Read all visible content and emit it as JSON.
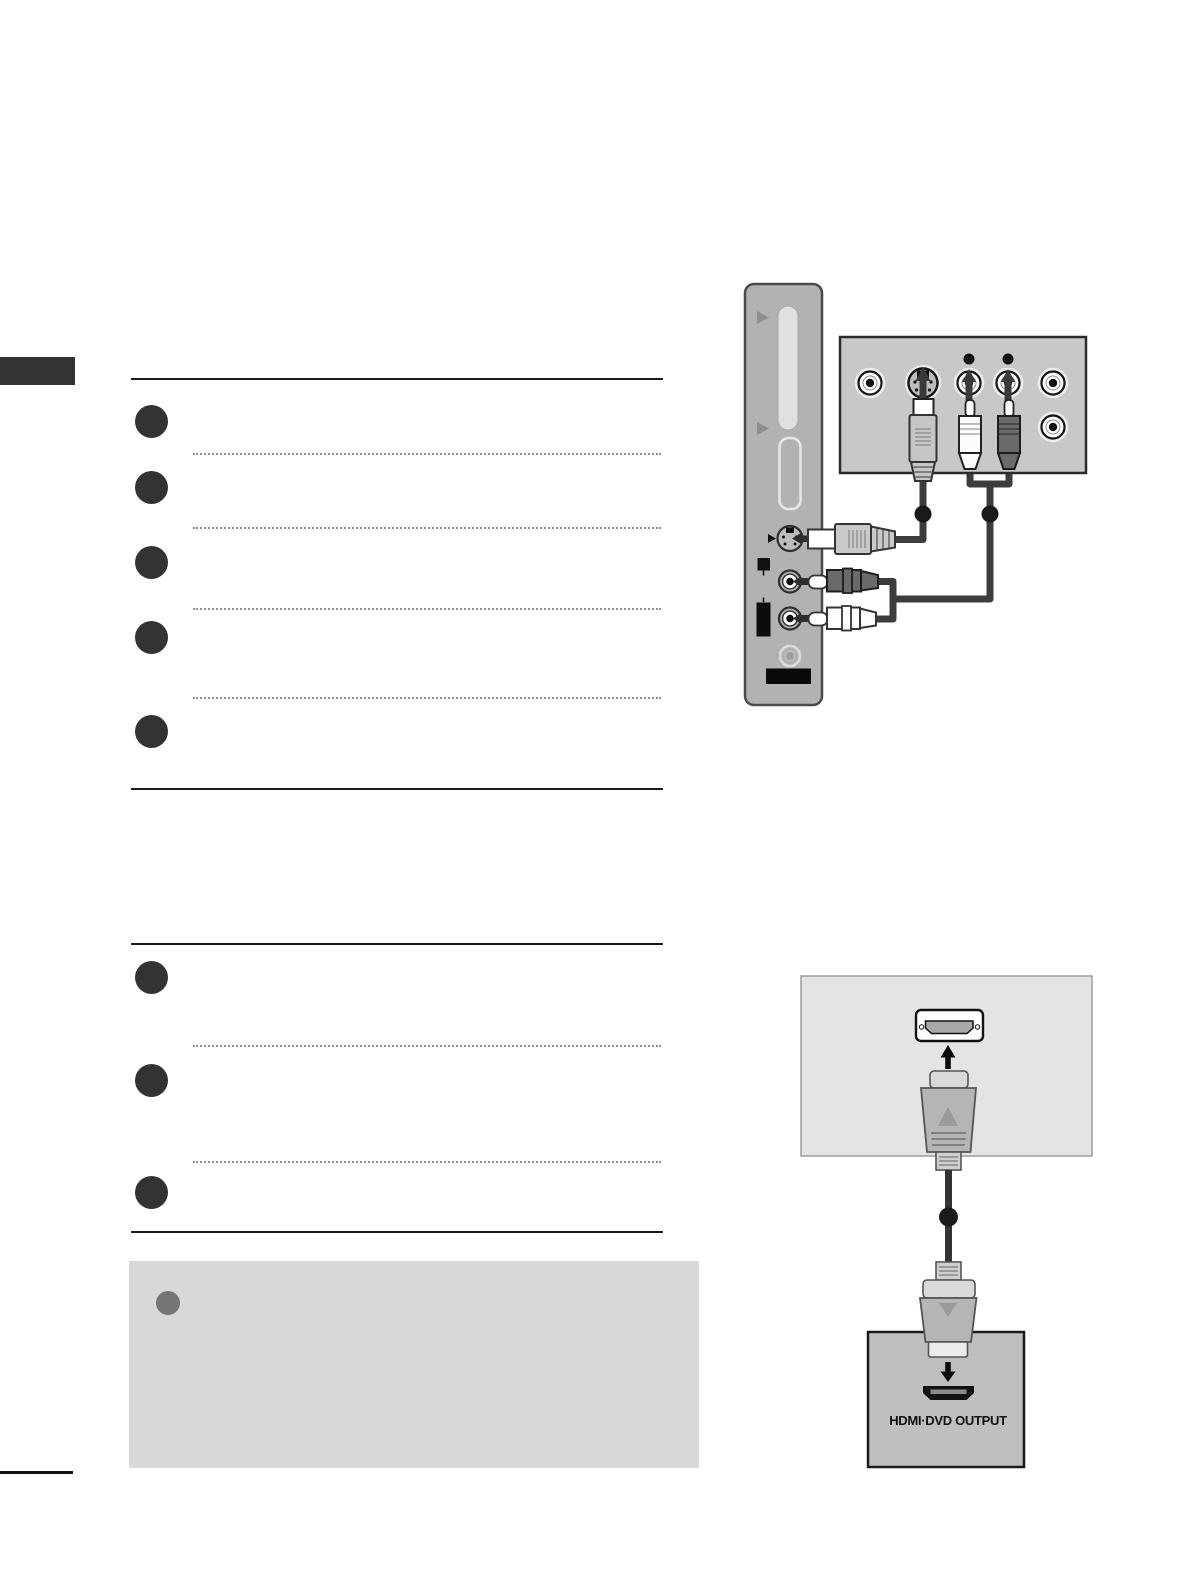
{
  "page": {
    "type": "tv-user-manual-page",
    "background": "#ffffff",
    "chapter_tab_color": "#333333",
    "rule_color": "#1a1a1a",
    "step_marker_color": "#333333"
  },
  "instructions": {
    "section_1": {
      "step_count": 5
    },
    "section_2": {
      "step_count": 3
    }
  },
  "note_box": {
    "background": "#d8d8d8",
    "bullet_color": "#757575"
  },
  "diagrams": {
    "side_av": {
      "tv_side_panel": {
        "panel_color": "#b2b2b2",
        "ports": [
          "card-slot",
          "s-video-port",
          "audio-rca-jack-top",
          "audio-rca-jack-bottom",
          "headphone-jack"
        ]
      },
      "device_rear_panel": {
        "panel_color": "#c8c8c8",
        "ports": [
          "rca-jack-left",
          "s-video-port",
          "audio-rca-jack-1",
          "audio-rca-jack-2",
          "rca-jack-right-top",
          "rca-jack-right-bottom"
        ]
      },
      "cables": [
        "s-video-cable",
        "audio-rca-cable-pair"
      ],
      "cable_color": "#3d3d3d",
      "ferrite_dot_color": "#1a1a1a"
    },
    "hdmi": {
      "tv_back_panel_color": "#e4e4e4",
      "device_panel_color": "#bfbfbf",
      "plug_color": "#b5b5b5",
      "cable_color": "#333333",
      "output_label": "HDMI·DVD OUTPUT"
    }
  }
}
